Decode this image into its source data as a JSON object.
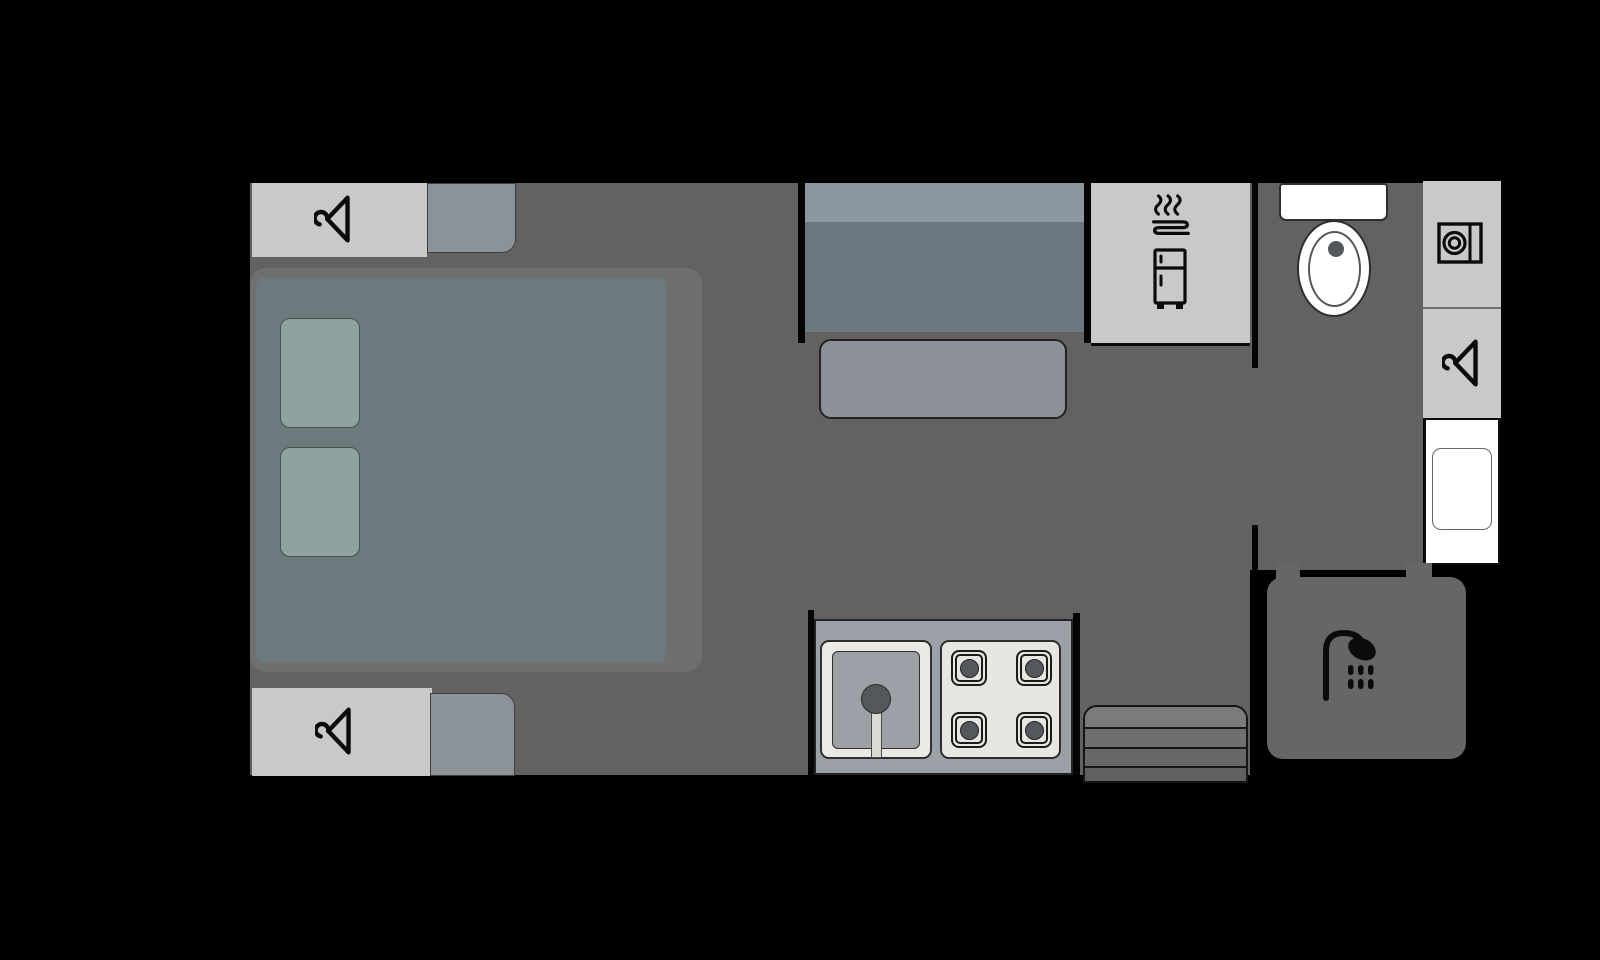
{
  "palette": {
    "background": "#000000",
    "floor": "#626262",
    "floor_shower": "#666666",
    "bed_base": "#6f6f6f",
    "mattress": "#6c7a7e",
    "pillow": "#8fa2a0",
    "wardrobe": "#c9c9c9",
    "cabinet": "#8b9298",
    "seat_back": "#8b97a1",
    "seat_cushion": "#6c7880",
    "table": "#8b9196",
    "appliance_unit": "#c9c9c9",
    "counter": "#9ba1a6",
    "sink": "#ebe9e4",
    "stove": "#e7e7e2",
    "burner": "#54585c",
    "fixture_white": "#ffffff",
    "icon": "#0b0b0b",
    "step_bands": [
      "#7b7b7b",
      "#6f6f6f",
      "#686868",
      "#606060"
    ]
  },
  "plan": {
    "type": "caravan-floorplan",
    "rooms": [
      {
        "name": "bedroom",
        "fixtures": [
          {
            "name": "wardrobe-top",
            "icon": "hanger-icon"
          },
          {
            "name": "overhead-cabinet-top"
          },
          {
            "name": "double-bed"
          },
          {
            "name": "pillow-left"
          },
          {
            "name": "pillow-right"
          },
          {
            "name": "wardrobe-bottom",
            "icon": "hanger-icon"
          },
          {
            "name": "overhead-cabinet-bottom"
          }
        ]
      },
      {
        "name": "living-kitchen",
        "fixtures": [
          {
            "name": "dinette-seat"
          },
          {
            "name": "dinette-table"
          },
          {
            "name": "appliance-unit",
            "icons": [
              "heat-steam-icon",
              "fridge-icon"
            ]
          },
          {
            "name": "kitchen-counter"
          },
          {
            "name": "sink",
            "icon": "faucet"
          },
          {
            "name": "stove",
            "burners": 4
          },
          {
            "name": "entry-step",
            "bands": 4
          }
        ]
      },
      {
        "name": "bathroom",
        "fixtures": [
          {
            "name": "toilet"
          },
          {
            "name": "washing-machine",
            "icon": "washing-machine-icon"
          },
          {
            "name": "bathroom-wardrobe",
            "icon": "hanger-icon"
          },
          {
            "name": "vanity-basin"
          },
          {
            "name": "shower",
            "icon": "shower-icon"
          }
        ]
      }
    ]
  }
}
